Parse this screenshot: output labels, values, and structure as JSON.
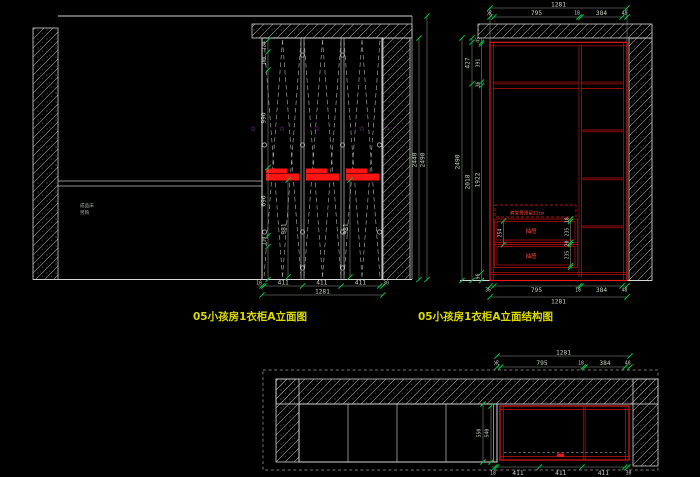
{
  "canvas": {
    "background": "#000000"
  },
  "colors": {
    "line": "#d6d6d6",
    "dim_text": "#c6cfc2",
    "tick_green": "#00c040",
    "structure_red": "#f01818",
    "star_magenta": "#c858e8",
    "title_yellow": "#d9d900"
  },
  "elevation": {
    "title": "05小孩房1衣柜A立面图",
    "note_line1": "成品床",
    "note_line2": "另购",
    "dims": {
      "seg120": "120",
      "seg180": "180",
      "seg990": "990",
      "seg690": "690",
      "seg110": "110",
      "door_height": "981",
      "cabinet_height": "2440",
      "overall_height": "2490",
      "seg18": "18",
      "seg411": "411",
      "seg30": "30",
      "total_width": "1281"
    }
  },
  "structure": {
    "title": "05小孩房1衣柜A立面结构图",
    "dims": {
      "seg36": "36",
      "seg795": "795",
      "seg18": "18",
      "seg384": "384",
      "seg48": "48",
      "total_width": "1281",
      "seg45": "45",
      "seg427": "427",
      "seg2018": "2018",
      "panel18": "18",
      "seg391": "391",
      "shelf36": "36",
      "seg1922": "1922",
      "seg96": "96",
      "overall_height": "2490",
      "drawer18": "18",
      "drawer235": "235",
      "gap20": "20",
      "front254": "254"
    },
    "annotations": {
      "reserve_note": "裤架需预留12cm",
      "drawer_label": "抽屉"
    }
  },
  "plan": {
    "dims": {
      "seg36": "36",
      "seg795": "795",
      "seg18": "18",
      "seg384": "384",
      "seg48": "48",
      "total_width": "1281",
      "depth_outer": "550",
      "depth_inner": "540",
      "seg18b": "18",
      "seg411": "411",
      "seg30": "30"
    }
  }
}
